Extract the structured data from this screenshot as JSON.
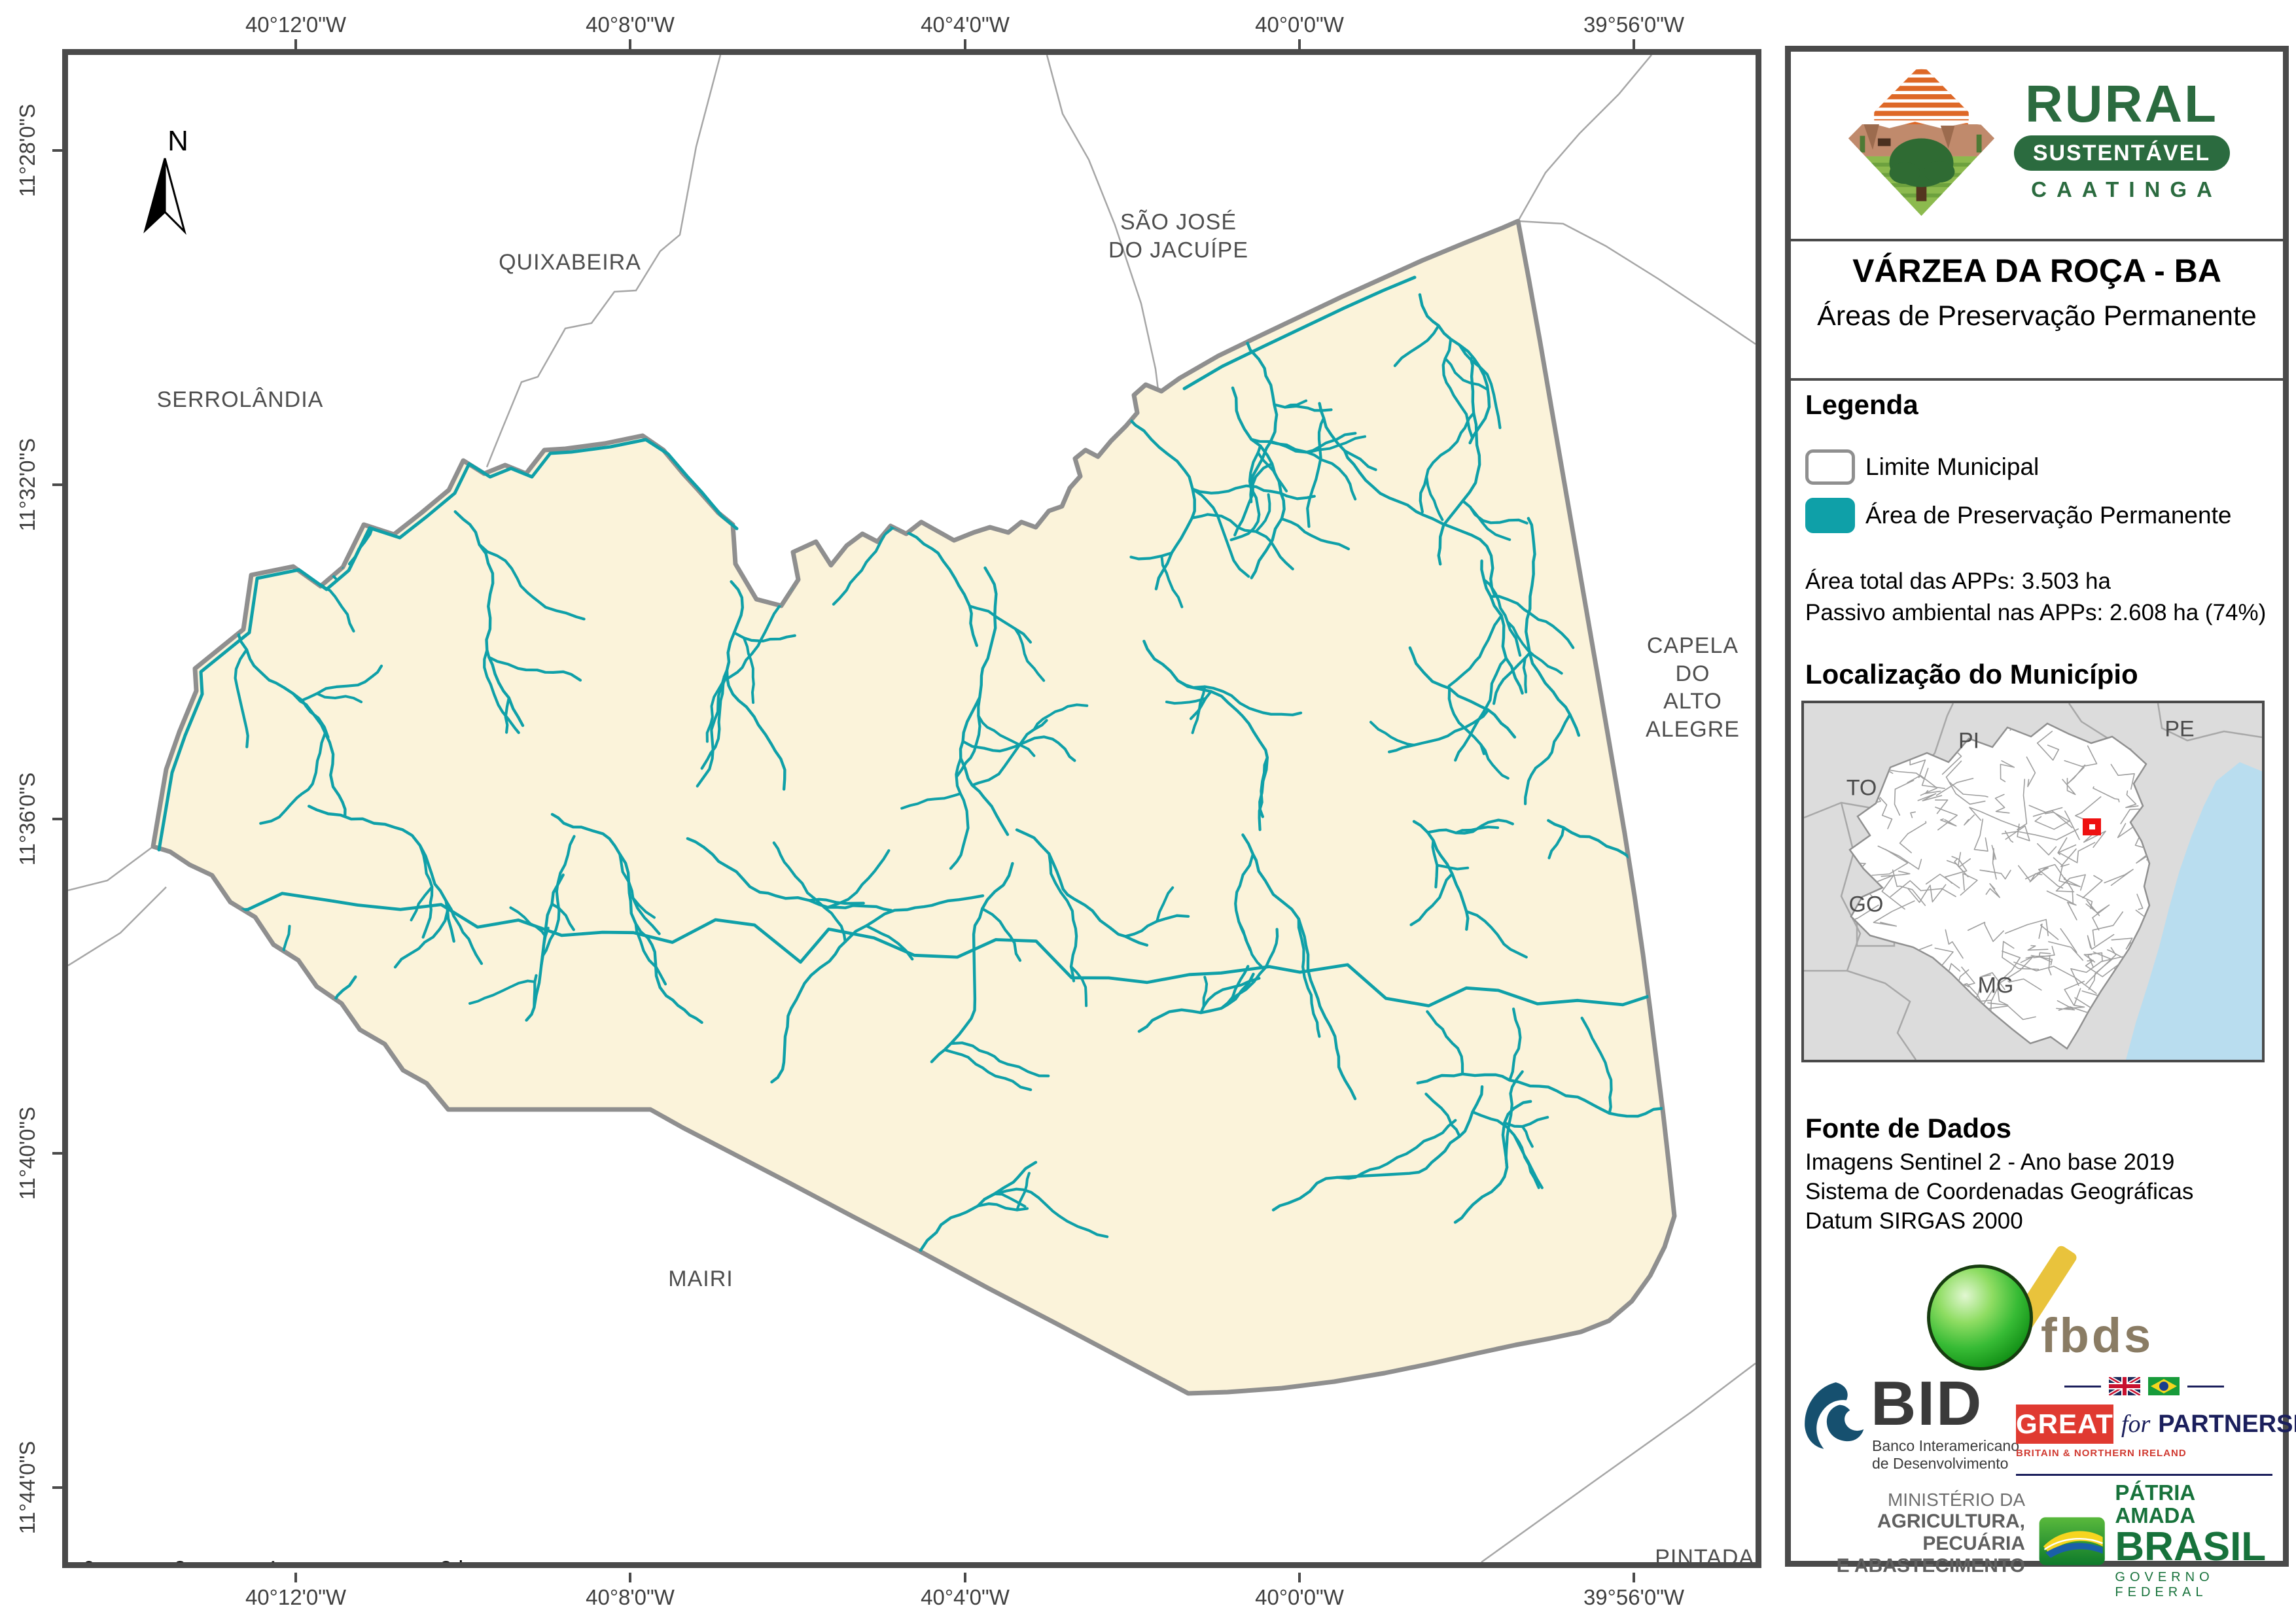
{
  "map": {
    "north": "N",
    "top_coords": [
      "40°12'0\"W",
      "40°8'0\"W",
      "40°4'0\"W",
      "40°0'0\"W",
      "39°56'0\"W"
    ],
    "bottom_coords": [
      "40°12'0\"W",
      "40°8'0\"W",
      "40°4'0\"W",
      "40°0'0\"W",
      "39°56'0\"W"
    ],
    "left_coords": [
      "11°28'0\"S",
      "11°32'0\"S",
      "11°36'0\"S",
      "11°40'0\"S",
      "11°44'0\"S"
    ],
    "neighbors": {
      "quixabeira": "QUIXABEIRA",
      "serrolandia": "SERROLÂNDIA",
      "sao_jose": "SÃO JOSÉ\nDO JACUÍPE",
      "capela": "CAPELA DO\nALTO ALEGRE",
      "mairi": "MAIRI",
      "pintadas": "PINTADAS"
    },
    "scalebar_labels": [
      "0",
      "2",
      "4",
      "8 km"
    ]
  },
  "panel": {
    "logo": {
      "line1": "RURAL",
      "line2": "SUSTENTÁVEL",
      "line3": "CAATINGA"
    },
    "title": "VÁRZEA DA ROÇA - BA",
    "subtitle": "Áreas de Preservação Permanente",
    "legend": {
      "heading": "Legenda",
      "item_limit": "Limite Municipal",
      "item_app": "Área de Preservação Permanente",
      "stat1": "Área total das APPs: 3.503 ha",
      "stat2": "Passivo ambiental nas APPs: 2.608 ha (74%)"
    },
    "location": {
      "heading": "Localização do Município",
      "states": {
        "pi": "PI",
        "to": "TO",
        "go": "GO",
        "mg": "MG",
        "pe": "PE"
      }
    },
    "source": {
      "heading": "Fonte de Dados",
      "line1": "Imagens Sentinel 2 - Ano base 2019",
      "line2": "Sistema de Coordenadas Geográficas",
      "line3": "Datum SIRGAS 2000"
    },
    "logos": {
      "fbds": "fbds",
      "bid": {
        "word": "BID",
        "sub1": "Banco Interamericano",
        "sub2": "de Desenvolvimento"
      },
      "great": {
        "word": "GREAT",
        "conj": "for",
        "partner": "PARTNERSHIP",
        "sub": "BRITAIN & NORTHERN IRELAND"
      },
      "ministry": {
        "l1": "MINISTÉRIO DA",
        "l2": "AGRICULTURA, PECUÁRIA",
        "l3": "E ABASTECIMENTO"
      },
      "brasil": {
        "l1": "PÁTRIA AMADA",
        "l2": "BRASIL",
        "l3": "GOVERNO FEDERAL"
      }
    }
  },
  "colors": {
    "app_teal": "#0FA0A8",
    "municipality_fill": "#FBF3DA",
    "municipality_stroke": "#8F8F8F",
    "frame": "#4a4a4a",
    "ocean": "#B9DDEF",
    "marker_red": "#EE1111"
  }
}
